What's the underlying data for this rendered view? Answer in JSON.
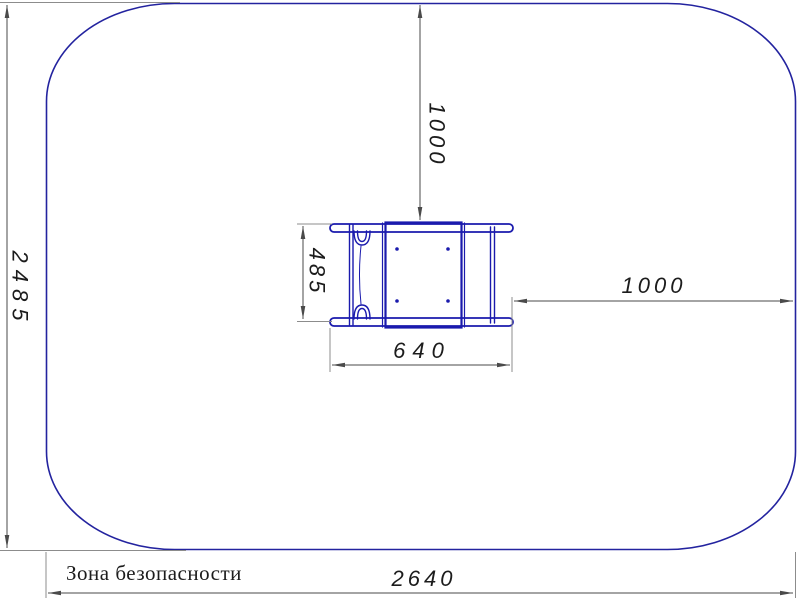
{
  "drawing": {
    "label": "Зона безопасности",
    "dimensions": {
      "zone_height": "2485",
      "top_clearance": "1000",
      "equipment_depth": "485",
      "equipment_width": "640",
      "right_clearance": "1000",
      "zone_width": "2640"
    }
  },
  "colors": {
    "zone": "#23239f",
    "equipment": "#1a1aad",
    "dimension": "#4a4a4a",
    "extension": "#8c8c8c",
    "text": "#1c1c1c",
    "background": "#ffffff"
  }
}
